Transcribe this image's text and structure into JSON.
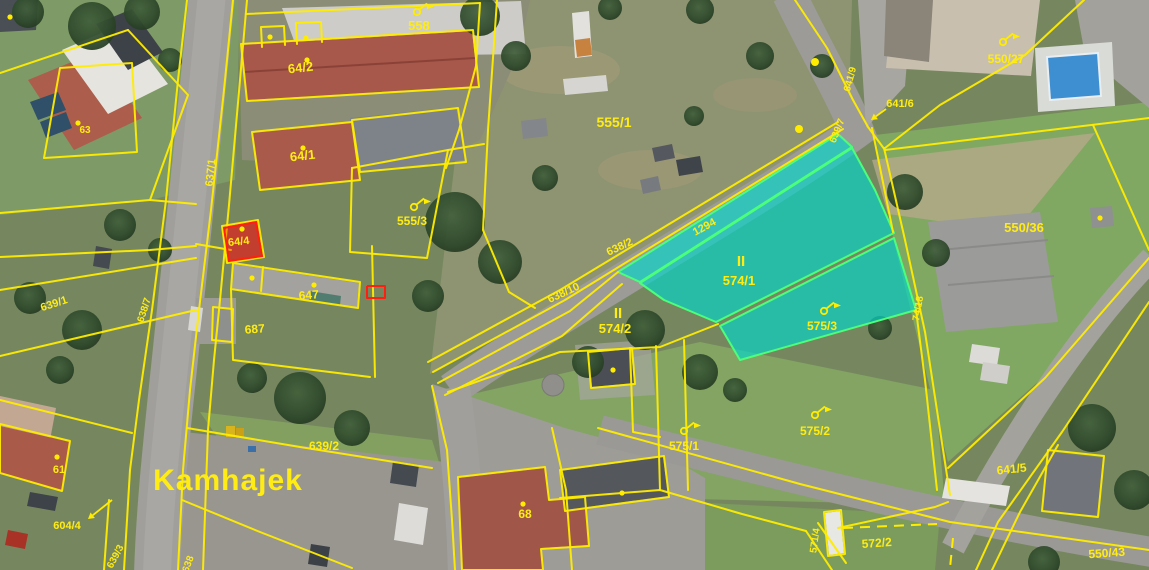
{
  "map": {
    "colors": {
      "parcel_line": "#ffec00",
      "highlight_fill": "#00d7cc",
      "highlight_border": "#4cff7a",
      "label": "#ffec14",
      "red_boundary": "#ff1f10"
    },
    "labels": [
      {
        "t": "558",
        "x": 419,
        "y": 30,
        "r": 0,
        "s": 13
      },
      {
        "t": "64/2",
        "x": 301,
        "y": 72,
        "r": -6,
        "s": 13
      },
      {
        "t": "63",
        "x": 85,
        "y": 133,
        "r": 0,
        "s": 10
      },
      {
        "t": "64/1",
        "x": 303,
        "y": 160,
        "r": -6,
        "s": 13
      },
      {
        "t": "637/1",
        "x": 214,
        "y": 173,
        "r": -84,
        "s": 11
      },
      {
        "t": "555/1",
        "x": 614,
        "y": 127,
        "r": 0,
        "s": 14
      },
      {
        "t": "555/3",
        "x": 412,
        "y": 225,
        "r": 0,
        "s": 12
      },
      {
        "t": "64/4",
        "x": 239,
        "y": 245,
        "r": -6,
        "s": 11
      },
      {
        "t": "647",
        "x": 309,
        "y": 299,
        "r": -4,
        "s": 12
      },
      {
        "t": "687",
        "x": 255,
        "y": 333,
        "r": -4,
        "s": 12
      },
      {
        "t": "550/27",
        "x": 1006,
        "y": 63,
        "r": 0,
        "s": 12
      },
      {
        "t": "641/6",
        "x": 900,
        "y": 107,
        "r": 0,
        "s": 11
      },
      {
        "t": "641/9",
        "x": 853,
        "y": 80,
        "r": -75,
        "s": 10
      },
      {
        "t": "639/7",
        "x": 840,
        "y": 132,
        "r": -68,
        "s": 10
      },
      {
        "t": "550/36",
        "x": 1024,
        "y": 232,
        "r": 0,
        "s": 13
      },
      {
        "t": "638/2",
        "x": 621,
        "y": 250,
        "r": -25,
        "s": 11
      },
      {
        "t": "1294",
        "x": 706,
        "y": 230,
        "r": -29,
        "s": 11
      },
      {
        "t": "638/10",
        "x": 565,
        "y": 296,
        "r": -25,
        "s": 11
      },
      {
        "t": "574/1",
        "x": 739,
        "y": 285,
        "r": 0,
        "s": 13
      },
      {
        "t": "574/2",
        "x": 615,
        "y": 333,
        "r": 0,
        "s": 13
      },
      {
        "t": "575/3",
        "x": 822,
        "y": 330,
        "r": 0,
        "s": 12
      },
      {
        "t": "74/18",
        "x": 921,
        "y": 309,
        "r": -80,
        "s": 10
      },
      {
        "t": "575/1",
        "x": 684,
        "y": 450,
        "r": 0,
        "s": 12
      },
      {
        "t": "575/2",
        "x": 815,
        "y": 435,
        "r": 0,
        "s": 12
      },
      {
        "t": "68",
        "x": 525,
        "y": 518,
        "r": 0,
        "s": 12
      },
      {
        "t": "639/2",
        "x": 324,
        "y": 450,
        "r": 0,
        "s": 12
      },
      {
        "t": "61",
        "x": 59,
        "y": 473,
        "r": 0,
        "s": 11
      },
      {
        "t": "604/4",
        "x": 67,
        "y": 529,
        "r": 0,
        "s": 11
      },
      {
        "t": "639/3",
        "x": 118,
        "y": 558,
        "r": -62,
        "s": 10
      },
      {
        "t": "638",
        "x": 191,
        "y": 565,
        "r": -70,
        "s": 10
      },
      {
        "t": "571/4",
        "x": 818,
        "y": 541,
        "r": -82,
        "s": 10
      },
      {
        "t": "572/2",
        "x": 877,
        "y": 547,
        "r": -4,
        "s": 12
      },
      {
        "t": "641/5",
        "x": 1012,
        "y": 473,
        "r": -6,
        "s": 12
      },
      {
        "t": "550/43",
        "x": 1107,
        "y": 557,
        "r": -4,
        "s": 12
      },
      {
        "t": "639/1",
        "x": 55,
        "y": 307,
        "r": -18,
        "s": 11
      },
      {
        "t": "638/7",
        "x": 147,
        "y": 311,
        "r": -72,
        "s": 10
      },
      {
        "t": "Kamhajek",
        "x": 228,
        "y": 490,
        "r": 0,
        "s": 30,
        "cls": "place"
      }
    ],
    "markers": {
      "flags": [
        {
          "x": 417,
          "y": 12
        },
        {
          "x": 414,
          "y": 207
        },
        {
          "x": 1003,
          "y": 42
        },
        {
          "x": 824,
          "y": 311
        },
        {
          "x": 684,
          "y": 431
        },
        {
          "x": 815,
          "y": 415
        }
      ],
      "ownership_symbols": [
        {
          "t": "II",
          "x": 741,
          "y": 266
        },
        {
          "t": "II",
          "x": 618,
          "y": 318
        }
      ],
      "arrows": [
        {
          "x1": 112,
          "y1": 500,
          "x2": 88,
          "y2": 519
        },
        {
          "x1": 886,
          "y1": 109,
          "x2": 871,
          "y2": 120
        }
      ],
      "survey_dots": [
        [
          78,
          123
        ],
        [
          270,
          37
        ],
        [
          306,
          38
        ],
        [
          307,
          60
        ],
        [
          303,
          148
        ],
        [
          242,
          229
        ],
        [
          252,
          278
        ],
        [
          314,
          285
        ],
        [
          523,
          504
        ],
        [
          622,
          493
        ],
        [
          613,
          370
        ],
        [
          57,
          457
        ],
        [
          1100,
          218
        ],
        [
          10,
          17
        ]
      ],
      "vertex_dots": [
        [
          815,
          62
        ],
        [
          799,
          129
        ]
      ]
    }
  }
}
